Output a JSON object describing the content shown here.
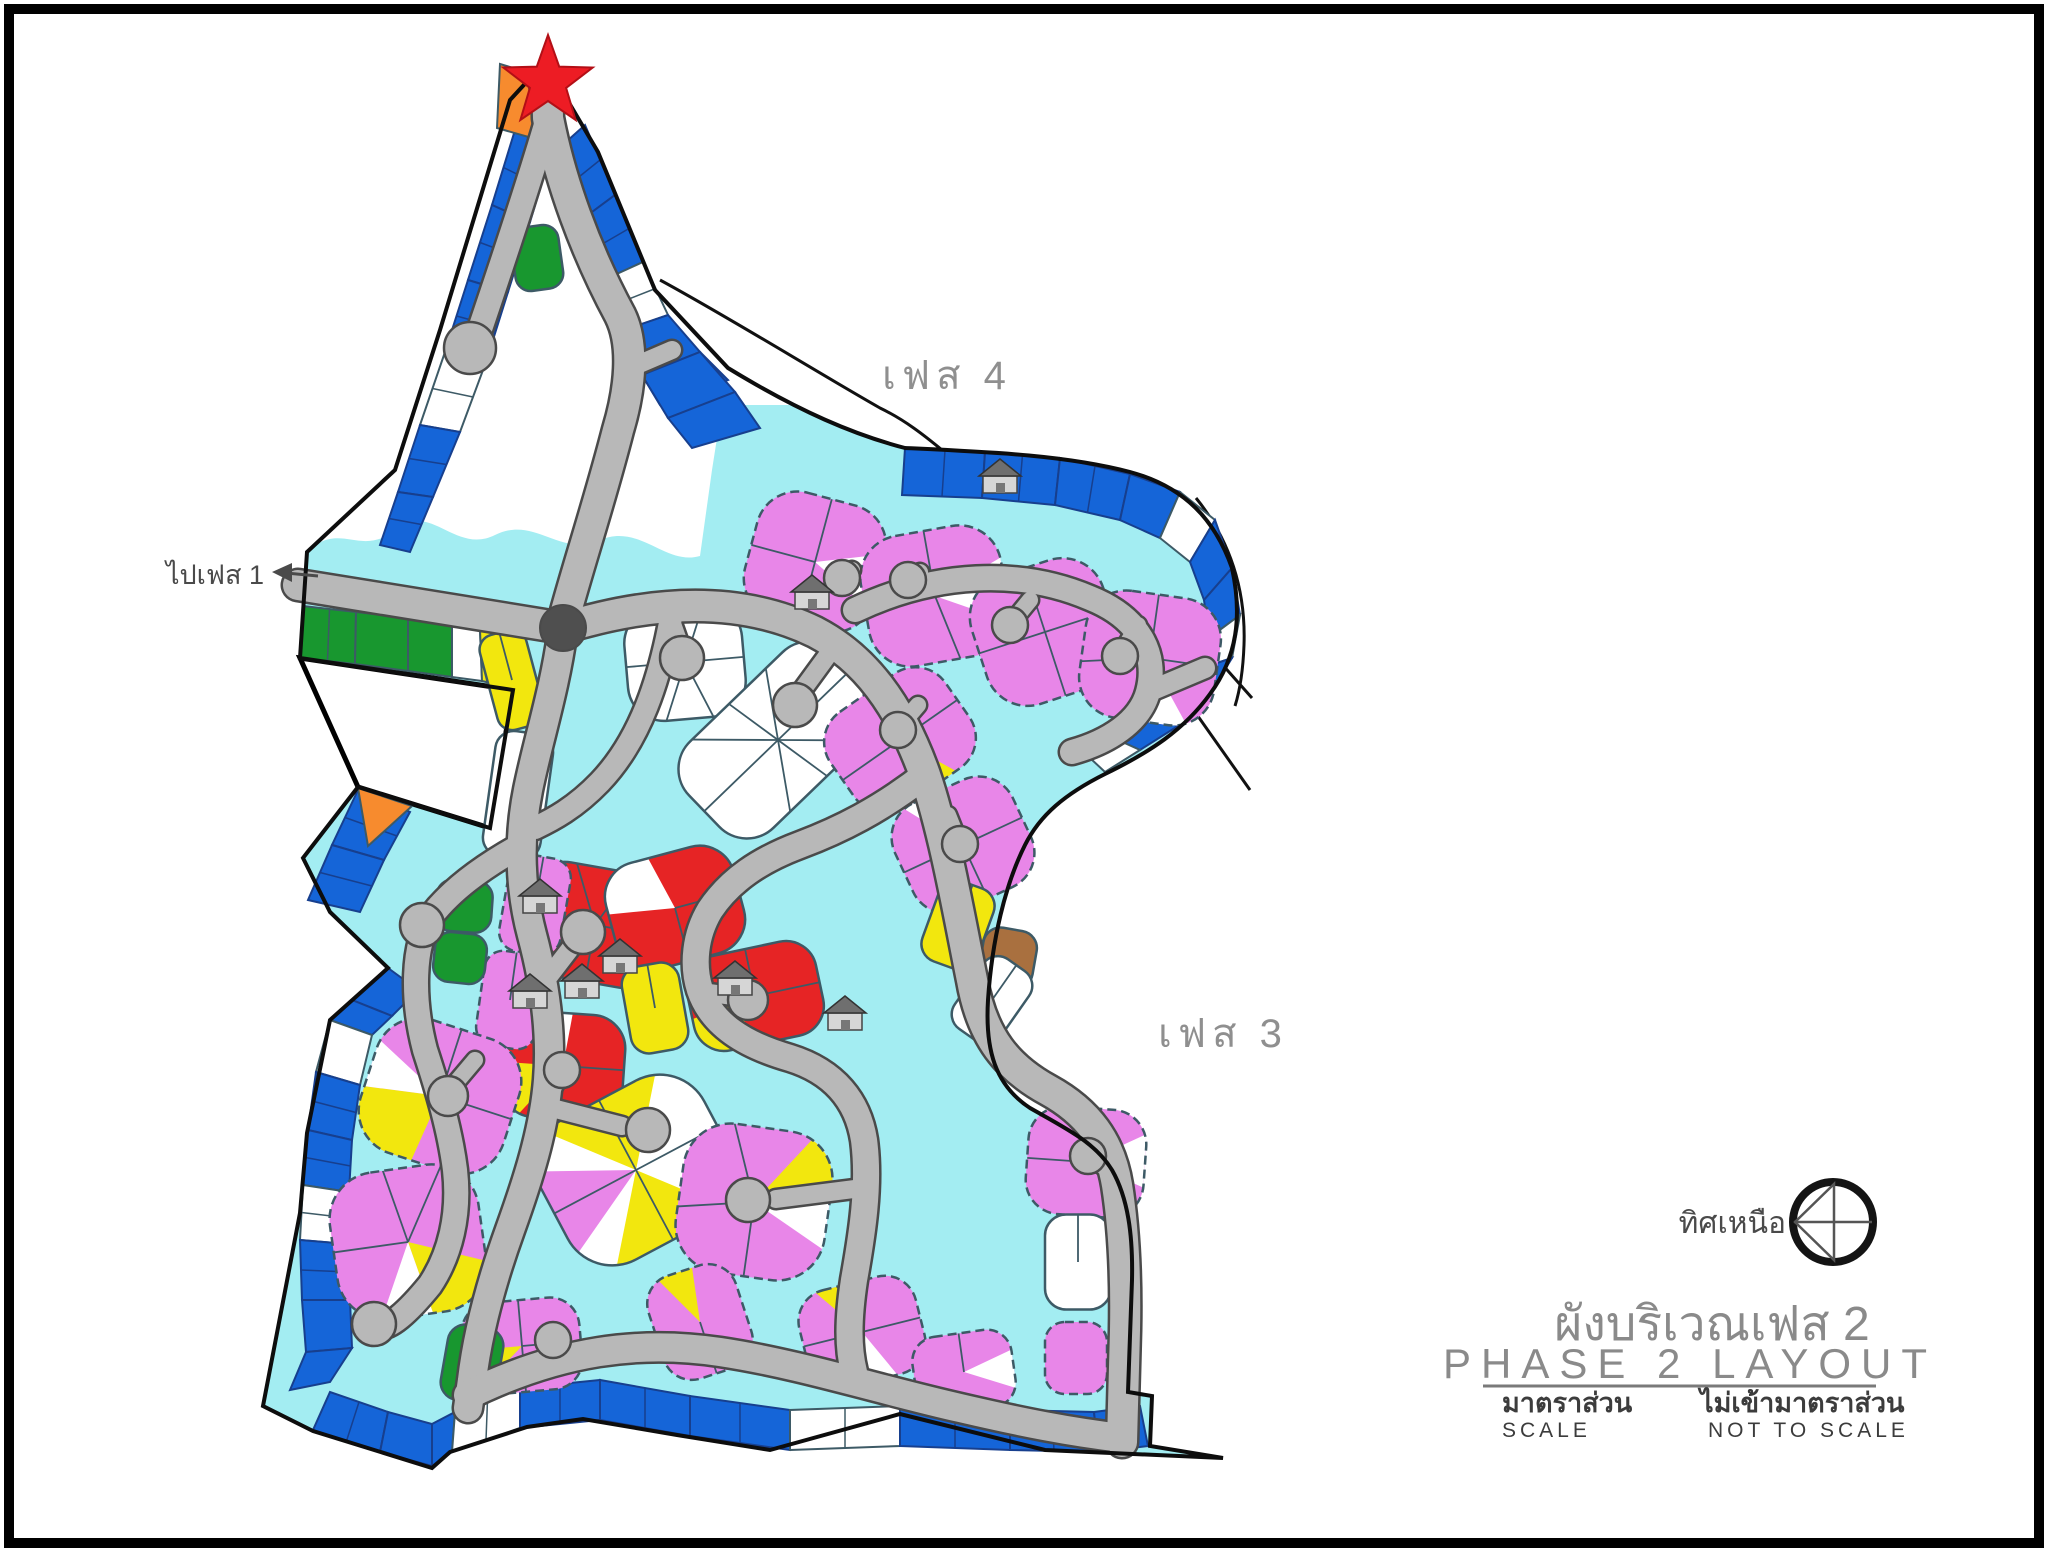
{
  "palette": {
    "lot_blue": "#1565d8",
    "lot_blue_line": "#173f8e",
    "lot_green": "#18972f",
    "lot_yellow": "#f2e70e",
    "lot_violet": "#e886e8",
    "lot_red": "#e62425",
    "lot_orange": "#f78b2e",
    "lot_brown": "#a9703f",
    "lot_white": "#ffffff",
    "area_cyan": "#a3edf2",
    "road_gray": "#b8b8b8",
    "road_edge": "#4a4a4a",
    "roundabout_gray": "#4f4f4f",
    "boundary_black": "#0d0d0d",
    "lot_line": "#3d5a66",
    "star_red": "#ed1c24",
    "label_gray": "#8f8f8f",
    "text_dark": "#3c3c3c"
  },
  "map": {
    "labels": {
      "phase4": "เฟส 4",
      "phase3": "เฟส 3",
      "to_phase1": "ไปเฟส 1"
    }
  },
  "north_indicator": {
    "label": "ทิศเหนือ"
  },
  "title_block": {
    "title_thai": "ผังบริเวณเฟส 2",
    "title_english": "PHASE 2 LAYOUT",
    "scale_heading_thai": "มาตราส่วน",
    "scale_heading_english": "SCALE",
    "scale_value_thai": "ไม่เข้ามาตราส่วน",
    "scale_value_english": "NOT TO SCALE"
  }
}
